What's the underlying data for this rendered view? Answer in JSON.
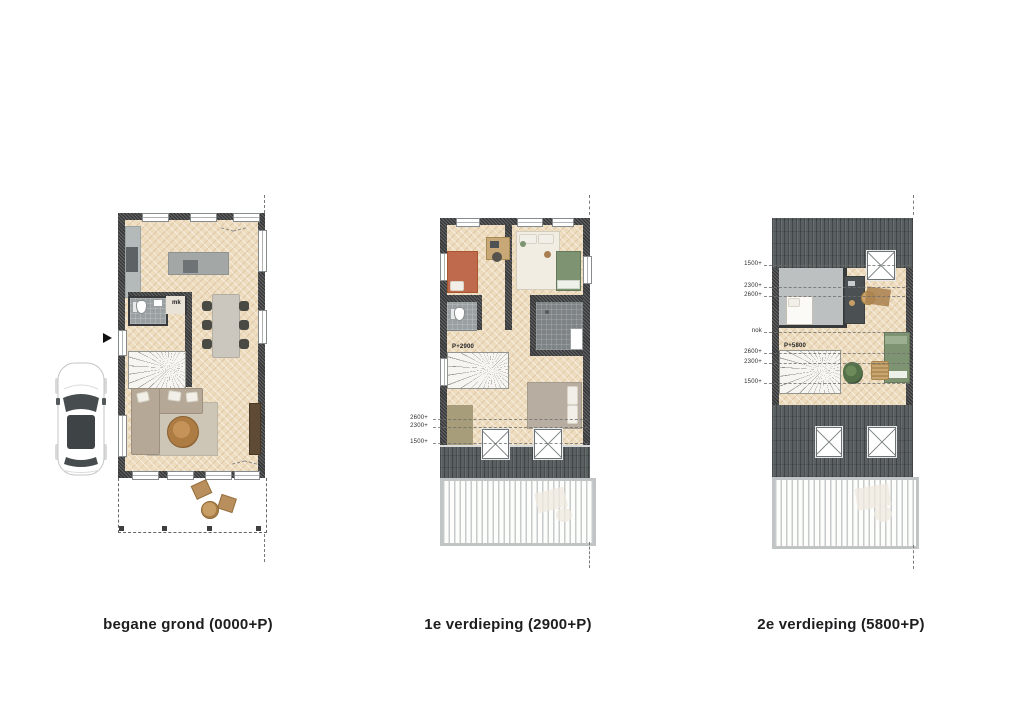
{
  "sheet": {
    "background": "#ffffff",
    "type": "floorplan-drawing"
  },
  "plans": {
    "ground": {
      "caption": "begane grond (0000+P)",
      "mk_label": "mk"
    },
    "first": {
      "caption": "1e verdieping (2900+P)",
      "peil_label": "P+2900",
      "height_lines": [
        "2600+",
        "2300+",
        "1500+"
      ]
    },
    "second": {
      "caption": "2e verdieping (5800+P)",
      "peil_label": "P+5800",
      "height_lines_top": [
        "1500+",
        "2300+",
        "2600+"
      ],
      "ridge_label": "nok",
      "height_lines_bottom": [
        "2600+",
        "2300+",
        "1500+"
      ]
    }
  },
  "colors": {
    "wall": "#38393a",
    "wood_floor": "#eedcbf",
    "roof": "#5a5f61",
    "tile_dark": "#7e8385",
    "tile_light": "#9aa0a1",
    "bed_terracotta": "#bf6a4c",
    "bed_green": "#7d9372",
    "sofa_taupe": "#b5a897",
    "coffee_table_wood": "#b5854f"
  }
}
